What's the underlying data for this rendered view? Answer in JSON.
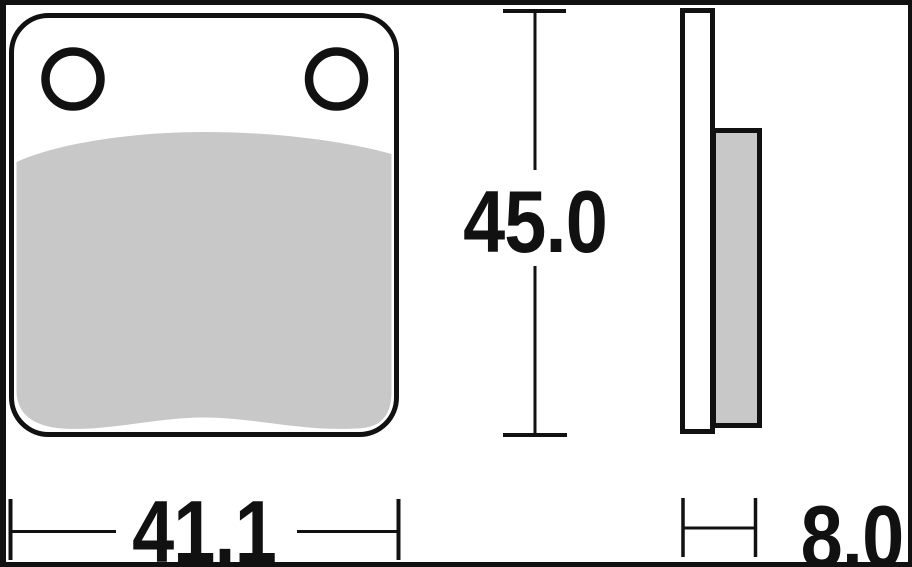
{
  "drawing": {
    "dimensions": {
      "height": {
        "label": "45.0"
      },
      "width": {
        "label": "41.1"
      },
      "thickness": {
        "label": "8.0"
      }
    },
    "colors": {
      "line": "#111111",
      "friction_material": "#c8c8c8",
      "background": "#ffffff"
    }
  }
}
